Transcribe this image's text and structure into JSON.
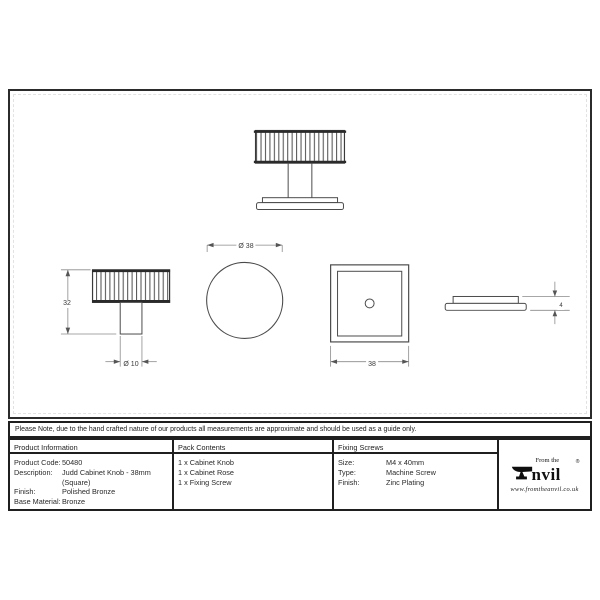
{
  "sheet": {
    "note": "Please Note, due to the hand crafted nature of our products all measurements are approximate and should be used as a guide only."
  },
  "drawing": {
    "dims": {
      "knob_diameter": "Ø 38",
      "knob_height": "32",
      "stem_diameter": "Ø 10",
      "rose_width": "38",
      "rose_thickness": "4"
    }
  },
  "table": {
    "product_information": {
      "header": "Product Information",
      "rows": [
        {
          "label": "Product Code:",
          "value": "50480"
        },
        {
          "label": "Description:",
          "value": "Judd Cabinet Knob - 38mm (Square)"
        },
        {
          "label": "Finish:",
          "value": "Polished Bronze"
        },
        {
          "label": "Base Material:",
          "value": "Bronze"
        }
      ]
    },
    "pack_contents": {
      "header": "Pack Contents",
      "items": [
        "1 x Cabinet Knob",
        "1 x Cabinet Rose",
        "1 x Fixing Screw"
      ]
    },
    "fixing_screws": {
      "header": "Fixing Screws",
      "rows": [
        {
          "label": "Size:",
          "value": "M4 x 40mm"
        },
        {
          "label": "Type:",
          "value": "Machine Screw"
        },
        {
          "label": "Finish:",
          "value": "Zinc Plating"
        }
      ]
    }
  },
  "brand": {
    "tagline": "From the",
    "wordmark": "nvil",
    "registered": "®",
    "website": "www.fromtheanvil.co.uk"
  },
  "colors": {
    "ink": "#1c1c1c",
    "object_line": "#4a4a4a",
    "dimension_line": "#8a8a8a"
  }
}
